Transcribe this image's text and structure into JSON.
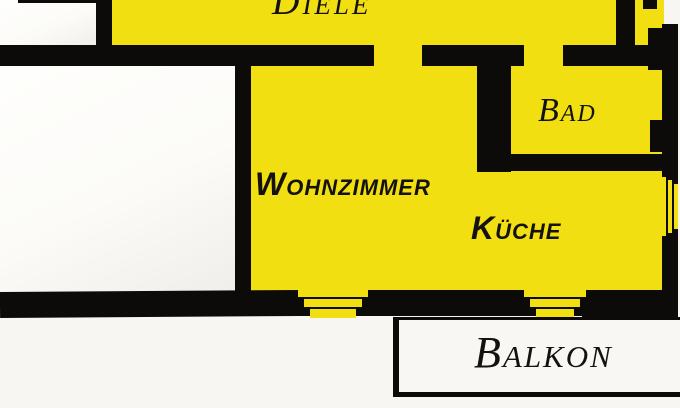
{
  "plan": {
    "rooms": {
      "diele": {
        "label": "Diele"
      },
      "bad": {
        "label": "Bad"
      },
      "wohnzimmer": {
        "label": "Wohnzimmer"
      },
      "kueche": {
        "label": "Küche"
      },
      "balkon": {
        "label": "Balkon"
      }
    },
    "colors": {
      "room_fill": "#f2df12",
      "wall": "#0d0b09",
      "background": "#f7f6f2",
      "room_white": "#fcfbf8"
    }
  }
}
